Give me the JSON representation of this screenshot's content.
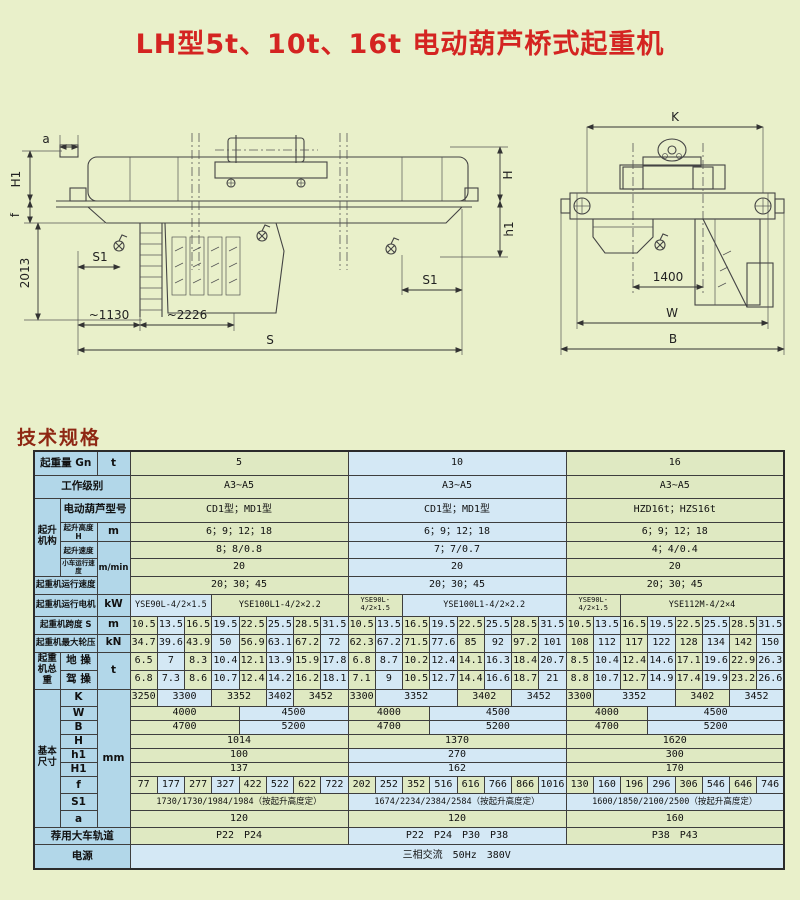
{
  "page": {
    "title": "LH型5t、10t、16t 电动葫芦桥式起重机",
    "section_heading": "技术规格"
  },
  "drawing": {
    "front": {
      "a": "a",
      "H1": "H1",
      "f": "f",
      "dim2013": "2013",
      "S1_left": "S1",
      "dim1130": "~1130",
      "dim2226": "~2226",
      "S": "S",
      "H": "H",
      "h1": "h1",
      "S1_right": "S1"
    },
    "end": {
      "K": "K",
      "dim1400": "1400",
      "W": "W",
      "B": "B"
    }
  },
  "table": {
    "capacities": [
      "5",
      "10",
      "16"
    ],
    "rows": [
      {
        "h": 24,
        "cells": [
          {
            "t": "起重量 Gn",
            "cs": 2,
            "cls": "lab"
          },
          {
            "t": "t",
            "cs": 1,
            "cls": "lab"
          },
          {
            "t": "5",
            "cs": 8,
            "cls": "g"
          },
          {
            "t": "10",
            "cs": 8,
            "cls": "b"
          },
          {
            "t": "16",
            "cs": 8,
            "cls": "g"
          }
        ]
      },
      {
        "h": 23,
        "cells": [
          {
            "t": "工作级别",
            "cs": 3,
            "cls": "lab"
          },
          {
            "t": "A3~A5",
            "cs": 8,
            "cls": "g"
          },
          {
            "t": "A3~A5",
            "cs": 8,
            "cls": "b"
          },
          {
            "t": "A3~A5",
            "cs": 8,
            "cls": "g"
          }
        ]
      },
      {
        "h": 24,
        "cells": [
          {
            "t": "起升机构",
            "cs": 1,
            "rs": 4,
            "cls": "lab grp"
          },
          {
            "t": "电动葫芦型号",
            "cs": 2,
            "cls": "lab"
          },
          {
            "t": "CD1型；MD1型",
            "cs": 8,
            "cls": "g"
          },
          {
            "t": "CD1型；MD1型",
            "cs": 8,
            "cls": "b"
          },
          {
            "t": "HZD16t；HZS16t",
            "cs": 8,
            "cls": "g"
          }
        ]
      },
      {
        "h": 19,
        "cells": [
          {
            "t": "起升高度H",
            "cs": 1,
            "cls": "lab xs"
          },
          {
            "t": "m",
            "cs": 1,
            "cls": "lab"
          },
          {
            "t": "6；9；12；18",
            "cs": 8,
            "cls": "g"
          },
          {
            "t": "6；9；12；18",
            "cs": 8,
            "cls": "b"
          },
          {
            "t": "6；9；12；18",
            "cs": 8,
            "cls": "g"
          }
        ]
      },
      {
        "h": 17,
        "cells": [
          {
            "t": "起升速度",
            "cs": 1,
            "cls": "lab xs"
          },
          {
            "t": "m/min",
            "cs": 1,
            "rs": 3,
            "cls": "lab sm"
          },
          {
            "t": "8；8/0.8",
            "cs": 8,
            "cls": "g"
          },
          {
            "t": "7；7/0.7",
            "cs": 8,
            "cls": "b"
          },
          {
            "t": "4；4/0.4",
            "cs": 8,
            "cls": "g"
          }
        ]
      },
      {
        "h": 17,
        "cells": [
          {
            "t": "小车运行速度",
            "cs": 1,
            "cls": "lab xxs"
          },
          {
            "t": "20",
            "cs": 8,
            "cls": "g"
          },
          {
            "t": "20",
            "cs": 8,
            "cls": "b"
          },
          {
            "t": "20",
            "cs": 8,
            "cls": "g"
          }
        ]
      },
      {
        "h": 18,
        "cells": [
          {
            "t": "起重机运行速度",
            "cs": 2,
            "cls": "lab sm"
          },
          {
            "t": "20；30；45",
            "cs": 8,
            "cls": "g"
          },
          {
            "t": "20；30；45",
            "cs": 8,
            "cls": "b"
          },
          {
            "t": "20；30；45",
            "cs": 8,
            "cls": "g"
          }
        ]
      },
      {
        "h": 22,
        "cells": [
          {
            "t": "起重机运行电机",
            "cs": 2,
            "cls": "lab sm"
          },
          {
            "t": "kW",
            "cs": 1,
            "cls": "lab"
          },
          {
            "t": "YSE90L-4/2×1.5",
            "cs": 3,
            "cls": "b sm"
          },
          {
            "t": "YSE100L1-4/2×2.2",
            "cs": 5,
            "cls": "g sm"
          },
          {
            "t": "YSE90L-4/2×1.5",
            "cs": 2,
            "cls": "g tiny"
          },
          {
            "t": "YSE100L1-4/2×2.2",
            "cs": 6,
            "cls": "b sm"
          },
          {
            "t": "YSE90L-4/2×1.5",
            "cs": 2,
            "cls": "g tiny"
          },
          {
            "t": "YSE112M-4/2×4",
            "cs": 6,
            "cls": "g sm"
          }
        ]
      },
      {
        "h": 18,
        "cells": [
          {
            "t": "起重机跨度 S",
            "cs": 2,
            "cls": "lab sm"
          },
          {
            "t": "m",
            "cs": 1,
            "cls": "lab"
          },
          {
            "vals": [
              "10.5",
              "13.5",
              "16.5",
              "19.5",
              "22.5",
              "25.5",
              "28.5",
              "31.5",
              "10.5",
              "13.5",
              "16.5",
              "19.5",
              "22.5",
              "25.5",
              "28.5",
              "31.5",
              "10.5",
              "13.5",
              "16.5",
              "19.5",
              "22.5",
              "25.5",
              "28.5",
              "31.5"
            ]
          }
        ]
      },
      {
        "h": 18,
        "cells": [
          {
            "t": "起重机最大轮压",
            "cs": 2,
            "cls": "lab sm"
          },
          {
            "t": "kN",
            "cs": 1,
            "cls": "lab"
          },
          {
            "vals": [
              "34.7",
              "39.6",
              "43.9",
              "50",
              "56.9",
              "63.1",
              "67.2",
              "72",
              "62.3",
              "67.2",
              "71.5",
              "77.6",
              "85",
              "92",
              "97.2",
              "101",
              "108",
              "112",
              "117",
              "122",
              "128",
              "134",
              "142",
              "150"
            ]
          }
        ]
      },
      {
        "h": 18,
        "cells": [
          {
            "t": "起重机总重",
            "cs": 1,
            "rs": 2,
            "cls": "lab grp"
          },
          {
            "t": "地 操",
            "cs": 1,
            "cls": "lab"
          },
          {
            "t": "t",
            "cs": 1,
            "rs": 2,
            "cls": "lab"
          },
          {
            "vals": [
              "6.5",
              "7",
              "8.3",
              "10.4",
              "12.1",
              "13.9",
              "15.9",
              "17.8",
              "6.8",
              "8.7",
              "10.2",
              "12.4",
              "14.1",
              "16.3",
              "18.4",
              "20.7",
              "8.5",
              "10.4",
              "12.4",
              "14.6",
              "17.1",
              "19.6",
              "22.9",
              "26.3"
            ]
          }
        ]
      },
      {
        "h": 19,
        "cells": [
          {
            "t": "驾 操",
            "cs": 1,
            "cls": "lab"
          },
          {
            "vals": [
              "6.8",
              "7.3",
              "8.6",
              "10.7",
              "12.4",
              "14.2",
              "16.2",
              "18.1",
              "7.1",
              "9",
              "10.5",
              "12.7",
              "14.4",
              "16.6",
              "18.7",
              "21",
              "8.8",
              "10.7",
              "12.7",
              "14.9",
              "17.4",
              "19.9",
              "23.2",
              "26.6"
            ]
          }
        ]
      },
      {
        "h": 17,
        "cells": [
          {
            "t": "基本尺寸",
            "cs": 1,
            "rs": 9,
            "cls": "lab grp"
          },
          {
            "t": "K",
            "cs": 1,
            "cls": "lab"
          },
          {
            "t": "mm",
            "cs": 1,
            "rs": 9,
            "cls": "lab"
          },
          {
            "t": "3250",
            "cs": 1,
            "cls": "g"
          },
          {
            "t": "3300",
            "cs": 2,
            "cls": "b"
          },
          {
            "t": "3352",
            "cs": 2,
            "cls": "g"
          },
          {
            "t": "3402",
            "cs": 1,
            "cls": "b"
          },
          {
            "t": "3452",
            "cs": 2,
            "cls": "g"
          },
          {
            "t": "3300",
            "cs": 1,
            "cls": "g"
          },
          {
            "t": "3352",
            "cs": 3,
            "cls": "b"
          },
          {
            "t": "3402",
            "cs": 2,
            "cls": "g"
          },
          {
            "t": "3452",
            "cs": 2,
            "cls": "b"
          },
          {
            "t": "3300",
            "cs": 1,
            "cls": "g"
          },
          {
            "t": "3352",
            "cs": 3,
            "cls": "b"
          },
          {
            "t": "3402",
            "cs": 2,
            "cls": "g"
          },
          {
            "t": "3452",
            "cs": 2,
            "cls": "b"
          }
        ]
      },
      {
        "h": 14,
        "cells": [
          {
            "t": "W",
            "cs": 1,
            "cls": "lab"
          },
          {
            "t": "4000",
            "cs": 4,
            "cls": "g"
          },
          {
            "t": "4500",
            "cs": 4,
            "cls": "b"
          },
          {
            "t": "4000",
            "cs": 3,
            "cls": "g"
          },
          {
            "t": "4500",
            "cs": 5,
            "cls": "b"
          },
          {
            "t": "4000",
            "cs": 3,
            "cls": "g"
          },
          {
            "t": "4500",
            "cs": 5,
            "cls": "b"
          }
        ]
      },
      {
        "h": 14,
        "cells": [
          {
            "t": "B",
            "cs": 1,
            "cls": "lab"
          },
          {
            "t": "4700",
            "cs": 4,
            "cls": "g"
          },
          {
            "t": "5200",
            "cs": 4,
            "cls": "b"
          },
          {
            "t": "4700",
            "cs": 3,
            "cls": "g"
          },
          {
            "t": "5200",
            "cs": 5,
            "cls": "b"
          },
          {
            "t": "4700",
            "cs": 3,
            "cls": "g"
          },
          {
            "t": "5200",
            "cs": 5,
            "cls": "b"
          }
        ]
      },
      {
        "h": 14,
        "cells": [
          {
            "t": "H",
            "cs": 1,
            "cls": "lab"
          },
          {
            "t": "1014",
            "cs": 8,
            "cls": "g"
          },
          {
            "t": "1370",
            "cs": 8,
            "cls": "g"
          },
          {
            "t": "1620",
            "cs": 8,
            "cls": "g"
          }
        ]
      },
      {
        "h": 14,
        "cells": [
          {
            "t": "h1",
            "cs": 1,
            "cls": "lab"
          },
          {
            "t": "100",
            "cs": 8,
            "cls": "g"
          },
          {
            "t": "270",
            "cs": 8,
            "cls": "b"
          },
          {
            "t": "300",
            "cs": 8,
            "cls": "g"
          }
        ]
      },
      {
        "h": 14,
        "cells": [
          {
            "t": "H1",
            "cs": 1,
            "cls": "lab"
          },
          {
            "t": "137",
            "cs": 8,
            "cls": "g"
          },
          {
            "t": "162",
            "cs": 8,
            "cls": "b"
          },
          {
            "t": "170",
            "cs": 8,
            "cls": "g"
          }
        ]
      },
      {
        "h": 17,
        "cells": [
          {
            "t": "f",
            "cs": 1,
            "cls": "lab"
          },
          {
            "vals": [
              "77",
              "177",
              "277",
              "327",
              "422",
              "522",
              "622",
              "722",
              "202",
              "252",
              "352",
              "516",
              "616",
              "766",
              "866",
              "1016",
              "130",
              "160",
              "196",
              "296",
              "306",
              "546",
              "646",
              "746"
            ]
          }
        ]
      },
      {
        "h": 17,
        "cells": [
          {
            "t": "S1",
            "cs": 1,
            "cls": "lab"
          },
          {
            "t": "1730/1730/1984/1984（按起升高度定）",
            "cs": 8,
            "cls": "g sm"
          },
          {
            "t": "1674/2234/2384/2584（按起升高度定）",
            "cs": 8,
            "cls": "b sm"
          },
          {
            "t": "1600/1850/2100/2500（按起升高度定）",
            "cs": 8,
            "cls": "b sm"
          }
        ]
      },
      {
        "h": 17,
        "cells": [
          {
            "t": "a",
            "cs": 1,
            "cls": "lab"
          },
          {
            "t": "120",
            "cs": 8,
            "cls": "g"
          },
          {
            "t": "120",
            "cs": 8,
            "cls": "g"
          },
          {
            "t": "160",
            "cs": 8,
            "cls": "g"
          }
        ]
      },
      {
        "h": 17,
        "cells": [
          {
            "t": "荐用大车轨道",
            "cs": 3,
            "cls": "lab"
          },
          {
            "t": "P22　P24",
            "cs": 8,
            "cls": "g"
          },
          {
            "t": "P22　P24　P30　P38",
            "cs": 8,
            "cls": "b"
          },
          {
            "t": "P38　P43",
            "cs": 8,
            "cls": "g"
          }
        ]
      },
      {
        "h": 24,
        "cells": [
          {
            "t": "电源",
            "cs": 3,
            "cls": "lab"
          },
          {
            "t": "三相交流　50Hz　380V",
            "cs": 24,
            "cls": "b"
          }
        ]
      }
    ]
  },
  "colors": {
    "page_bg": "#e9f0ca",
    "title_red": "#d42421",
    "heading_red": "#8e2713",
    "label_cell_blue": "#b2d7e9",
    "data_cell_green": "#dfe9c2",
    "data_cell_blue": "#d4e8f5"
  }
}
